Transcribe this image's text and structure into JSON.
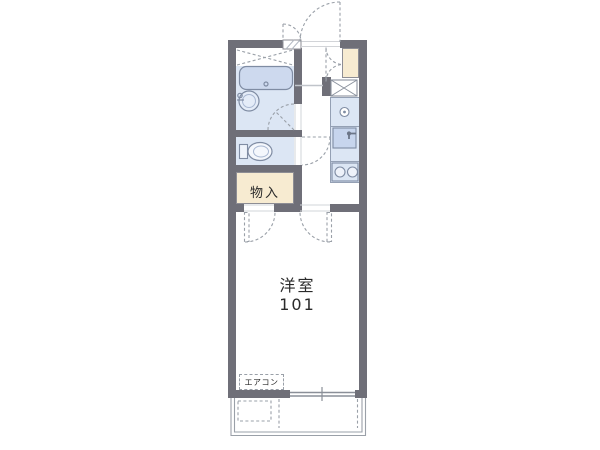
{
  "floorplan": {
    "labels": {
      "storage": "物入",
      "room_name": "洋室",
      "room_number": "101",
      "aircon": "エアコン"
    },
    "colors": {
      "wall": "#6f6f78",
      "water": "#dce6f4",
      "fixture": "#cdd9ee",
      "storage": "#f7ebd1",
      "line": "#9aa0a8",
      "jamb": "#d2d4d8",
      "stroke": "#7f8ca3",
      "text": "#2a2a2a"
    }
  }
}
